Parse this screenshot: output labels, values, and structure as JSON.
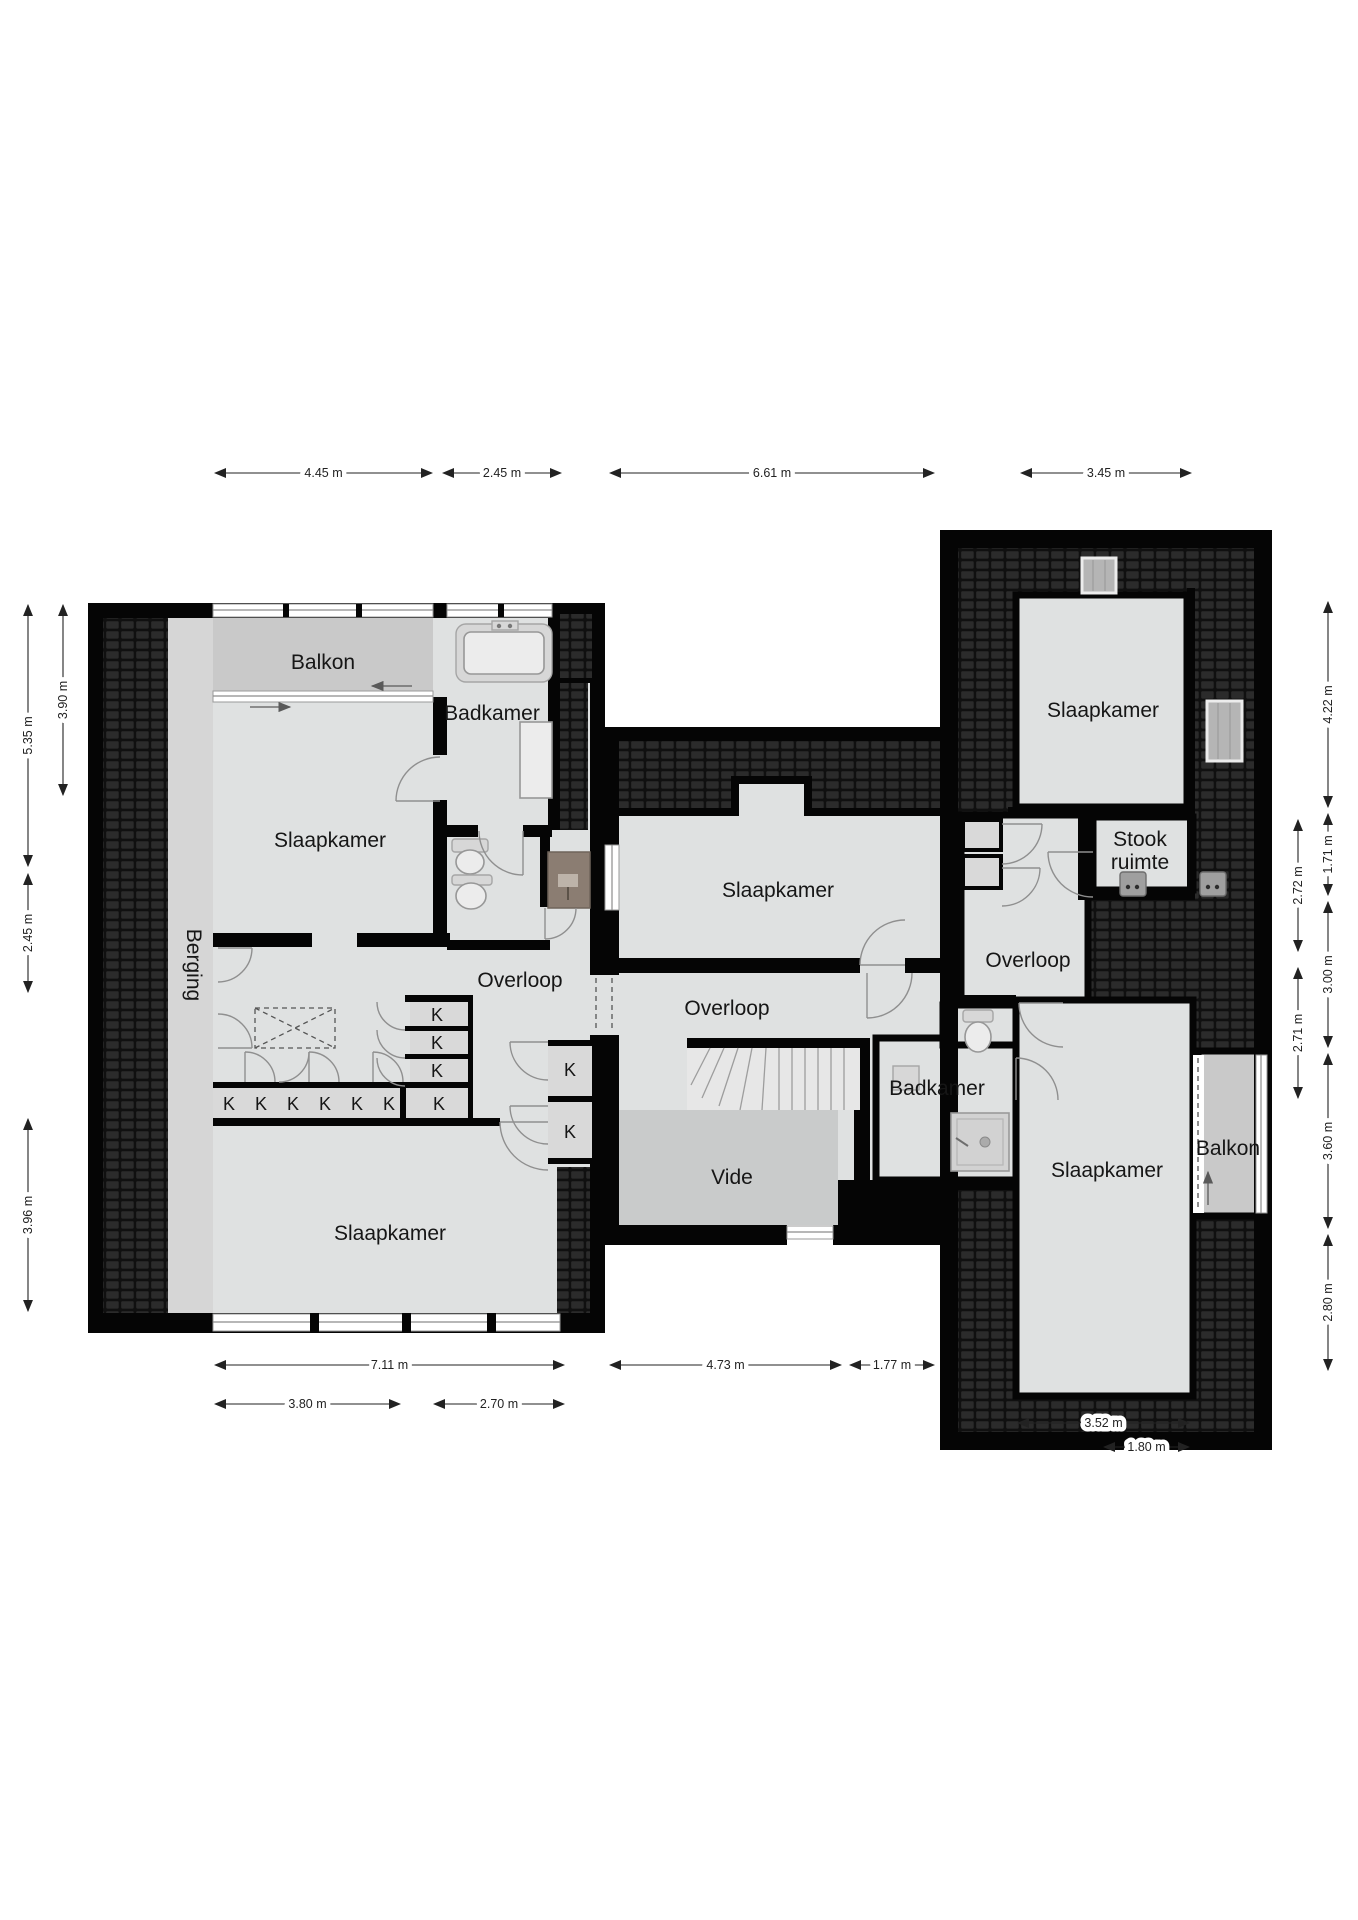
{
  "colors": {
    "wall": "#050505",
    "floor": "#dfe1e1",
    "balkon": "#c9c9c9",
    "berging": "#d6d6d6",
    "vide": "#c9cbcb",
    "stairs": "#e7e7e7",
    "closet": "#d9d9d9",
    "shower": "#8b7d72",
    "roof": "#101010",
    "rooftile": "#2b2b2b",
    "dim": "#222222"
  },
  "rooms": [
    {
      "id": "balkon-left",
      "label": "Balkon",
      "x": 323,
      "y": 669
    },
    {
      "id": "badkamer-left",
      "label": "Badkamer",
      "x": 492,
      "y": 720
    },
    {
      "id": "slaapkamer-top-left",
      "label": "Slaapkamer",
      "x": 330,
      "y": 847
    },
    {
      "id": "berging",
      "label": "Berging",
      "x": 187,
      "y": 965,
      "rotate": 90
    },
    {
      "id": "overloop-left",
      "label": "Overloop",
      "x": 520,
      "y": 987
    },
    {
      "id": "slaapkamer-bottom-left",
      "label": "Slaapkamer",
      "x": 390,
      "y": 1240
    },
    {
      "id": "slaapkamer-middle",
      "label": "Slaapkamer",
      "x": 778,
      "y": 897
    },
    {
      "id": "overloop-middle",
      "label": "Overloop",
      "x": 727,
      "y": 1015
    },
    {
      "id": "vide",
      "label": "Vide",
      "x": 732,
      "y": 1184
    },
    {
      "id": "badkamer-middle",
      "label": "Badkamer",
      "x": 937,
      "y": 1095
    },
    {
      "id": "overloop-right",
      "label": "Overloop",
      "x": 1028,
      "y": 967
    },
    {
      "id": "stook-ruimte",
      "label": "Stook ruimte",
      "lines": [
        "Stook",
        "ruimte"
      ],
      "x": 1140,
      "y": 846
    },
    {
      "id": "slaapkamer-right-top",
      "label": "Slaapkamer",
      "x": 1103,
      "y": 717
    },
    {
      "id": "slaapkamer-right-bottom",
      "label": "Slaapkamer",
      "x": 1107,
      "y": 1177
    },
    {
      "id": "balkon-right",
      "label": "Balkon",
      "x": 1228,
      "y": 1155
    }
  ],
  "closets": {
    "label": "K",
    "cells": [
      {
        "x": 437,
        "y": 1021
      },
      {
        "x": 437,
        "y": 1049
      },
      {
        "x": 437,
        "y": 1077
      },
      {
        "x": 229,
        "y": 1110
      },
      {
        "x": 261,
        "y": 1110
      },
      {
        "x": 293,
        "y": 1110
      },
      {
        "x": 325,
        "y": 1110
      },
      {
        "x": 357,
        "y": 1110
      },
      {
        "x": 389,
        "y": 1110
      },
      {
        "x": 439,
        "y": 1110
      },
      {
        "x": 570,
        "y": 1076
      },
      {
        "x": 570,
        "y": 1138
      }
    ]
  },
  "dims_h": [
    {
      "label": "4.45 m",
      "x1": 213,
      "x2": 434,
      "y": 473
    },
    {
      "label": "2.45 m",
      "x1": 441,
      "x2": 563,
      "y": 473
    },
    {
      "label": "6.61 m",
      "x1": 608,
      "x2": 936,
      "y": 473
    },
    {
      "label": "3.45 m",
      "x1": 1019,
      "x2": 1193,
      "y": 473
    },
    {
      "label": "7.11 m",
      "x1": 213,
      "x2": 566,
      "y": 1365
    },
    {
      "label": "4.73 m",
      "x1": 608,
      "x2": 843,
      "y": 1365
    },
    {
      "label": "1.77 m",
      "x1": 848,
      "x2": 936,
      "y": 1365
    },
    {
      "label": "3.80 m",
      "x1": 213,
      "x2": 402,
      "y": 1404
    },
    {
      "label": "2.70 m",
      "x1": 432,
      "x2": 566,
      "y": 1404
    },
    {
      "label": "3.52 m",
      "x1": 1016,
      "x2": 1191,
      "y": 1423
    },
    {
      "label": "1.80 m",
      "x1": 1102,
      "x2": 1191,
      "y": 1447
    }
  ],
  "dims_v": [
    {
      "label": "3.90 m",
      "x": 63,
      "y1": 603,
      "y2": 797
    },
    {
      "label": "5.35 m",
      "x": 28,
      "y1": 603,
      "y2": 868
    },
    {
      "label": "2.45 m",
      "x": 28,
      "y1": 872,
      "y2": 994
    },
    {
      "label": "3.96 m",
      "x": 28,
      "y1": 1117,
      "y2": 1313
    },
    {
      "label": "4.22 m",
      "x": 1328,
      "y1": 600,
      "y2": 809
    },
    {
      "label": "1.71 m",
      "x": 1328,
      "y1": 812,
      "y2": 897
    },
    {
      "label": "3.00 m",
      "x": 1328,
      "y1": 900,
      "y2": 1049
    },
    {
      "label": "3.60 m",
      "x": 1328,
      "y1": 1052,
      "y2": 1230
    },
    {
      "label": "2.80 m",
      "x": 1328,
      "y1": 1233,
      "y2": 1372
    },
    {
      "label": "2.72 m",
      "x": 1298,
      "y1": 818,
      "y2": 953
    },
    {
      "label": "2.71 m",
      "x": 1298,
      "y1": 966,
      "y2": 1100
    }
  ]
}
